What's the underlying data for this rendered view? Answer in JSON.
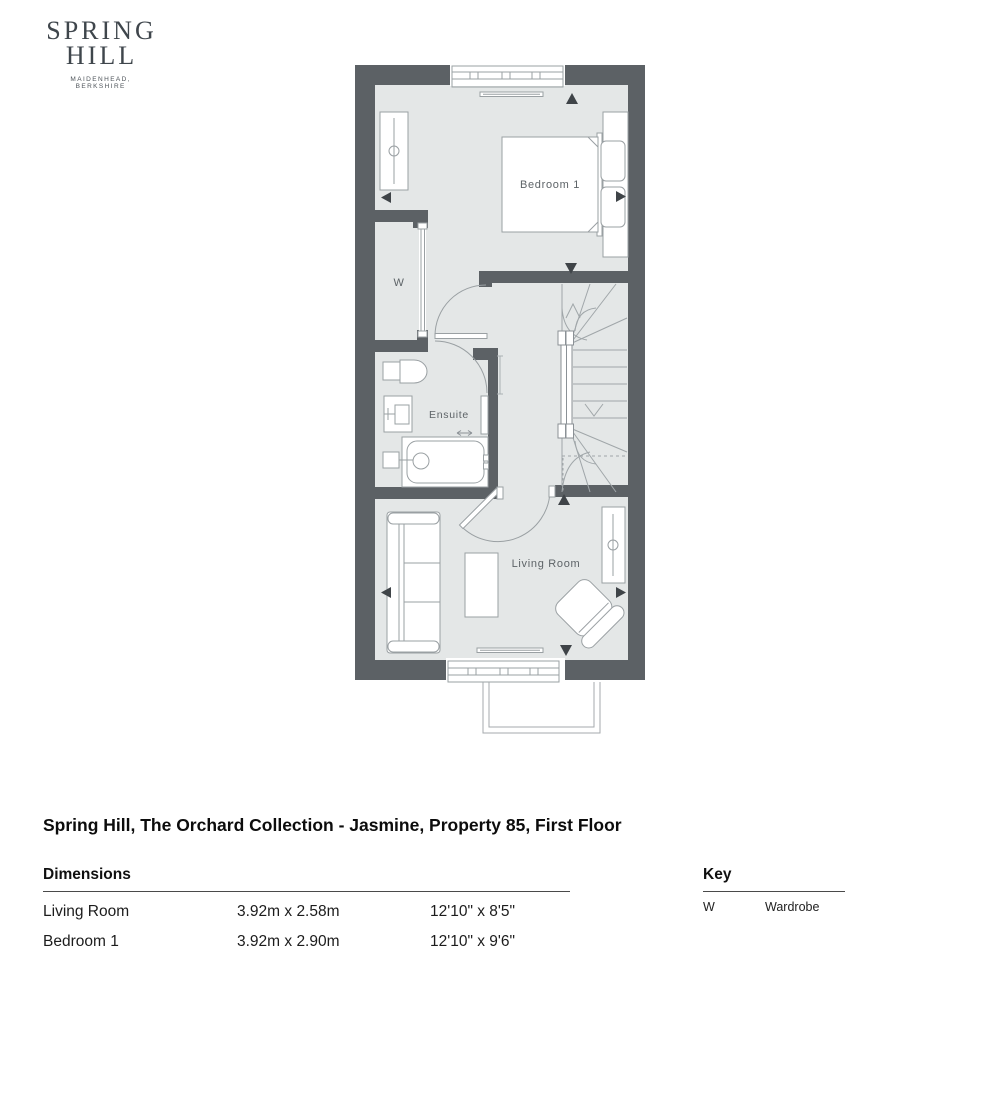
{
  "logo": {
    "line1": "SPRING",
    "line2": "HILL",
    "subtitle": "MAIDENHEAD, BERKSHIRE"
  },
  "title": "Spring Hill, The Orchard Collection - Jasmine, Property 85, First Floor",
  "plan": {
    "room_labels": {
      "bedroom1": "Bedroom 1",
      "wardrobe": "W",
      "ensuite": "Ensuite",
      "living_room": "Living Room"
    }
  },
  "dimensions_table": {
    "heading": "Dimensions",
    "rows": [
      {
        "room": "Living Room",
        "metric": "3.92m x 2.58m",
        "imperial": "12'10\" x 8'5\""
      },
      {
        "room": "Bedroom 1",
        "metric": "3.92m x 2.90m",
        "imperial": "12'10\" x 9'6\""
      }
    ]
  },
  "key": {
    "heading": "Key",
    "entries": [
      {
        "symbol": "W",
        "meaning": "Wardrobe"
      }
    ]
  },
  "colors": {
    "wall": "#5c6165",
    "room_fill": "#e4e7e7",
    "furniture_line": "#9aa0a3",
    "arrow": "#3f4448",
    "label_text": "#5d6367",
    "body_text": "#111111"
  }
}
